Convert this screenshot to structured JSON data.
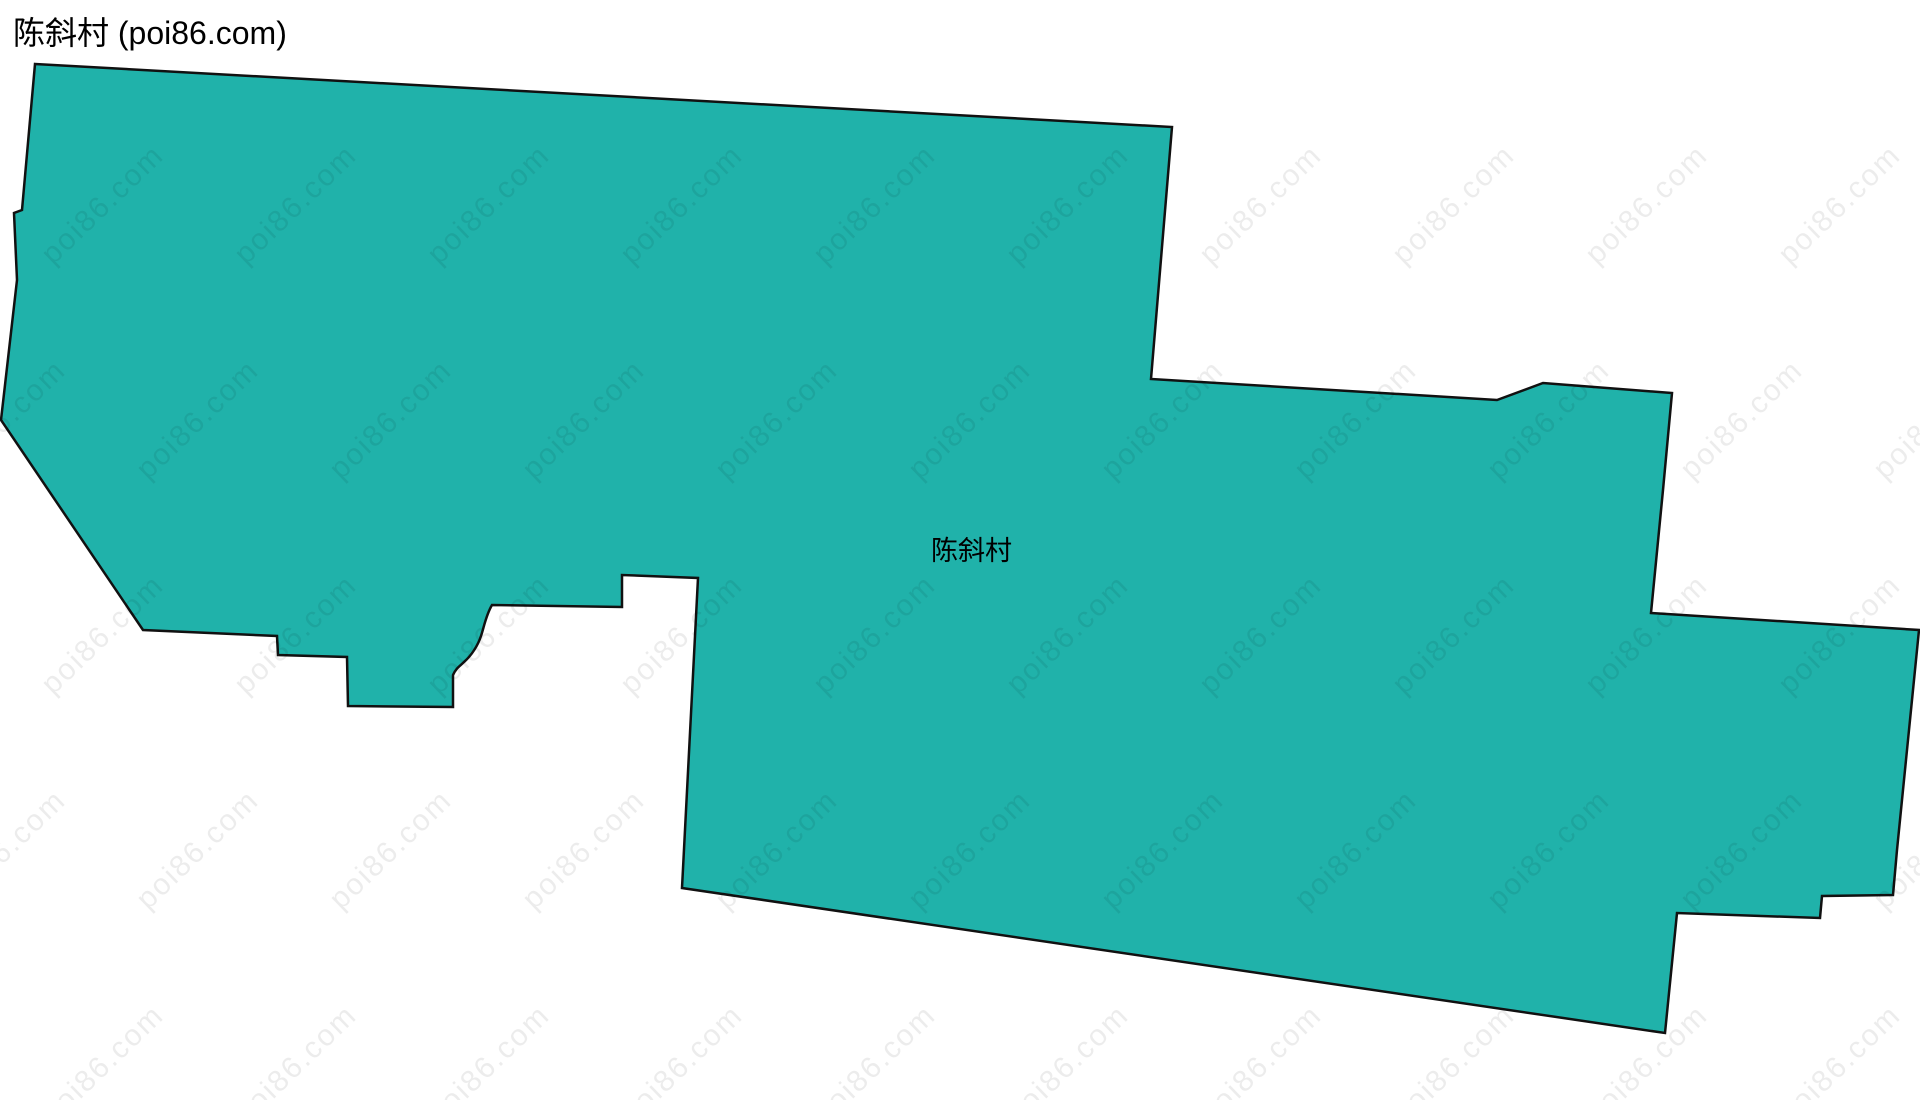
{
  "page_title": "陈斜村 (poi86.com)",
  "map": {
    "region_label": "陈斜村",
    "fill_color": "#20b2aa",
    "border_color": "#111111",
    "background_color": "#ffffff"
  },
  "watermark": {
    "text": "poi86.com"
  }
}
